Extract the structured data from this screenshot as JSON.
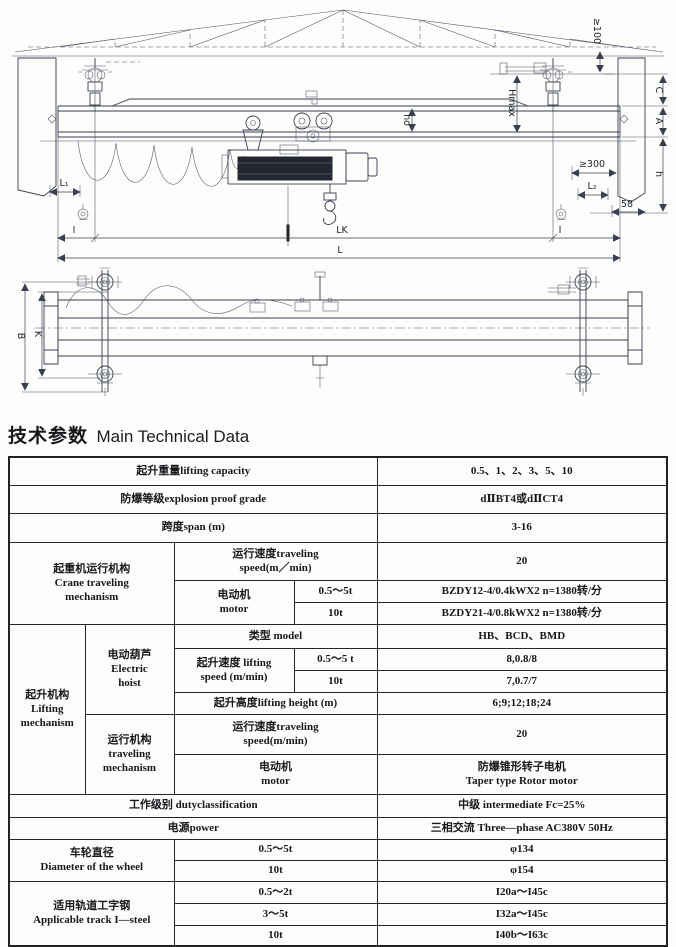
{
  "title": {
    "zh": "技术参数",
    "en": "Main Technical Data"
  },
  "drawing": {
    "front_view": {
      "clearance_top": "≥100",
      "hmax": "Hmax",
      "ho": "ho",
      "dim_c": "C",
      "dim_a": "A",
      "dim_h": "h",
      "clearance_side": "≥300",
      "dim_58": "58",
      "dim_l1": "L₁",
      "dim_l2": "L₂",
      "rail_left": "I",
      "rail_right": "I",
      "dim_lk": "LK",
      "dim_l": "L"
    },
    "plan_view": {
      "dim_b": "B",
      "dim_k": "K"
    }
  },
  "table": {
    "lifting_capacity_label": "起升重量lifting capacity",
    "lifting_capacity_value": "0.5、1、2、3、5、10",
    "explosion_label": "防爆等级explosion proof grade",
    "explosion_value": "dⅡBT4或dⅡCT4",
    "span_label": "跨度span (m)",
    "span_value": "3-16",
    "crane_traveling_group": "起重机运行机构\nCrane traveling\nmechanism",
    "ct_speed_label": "运行速度traveling\nspeed(m／min)",
    "ct_speed_value": "20",
    "ct_motor_label": "电动机\nmotor",
    "ct_motor_t1": "0.5～5t",
    "ct_motor_v1": "BZDY12-4/0.4kWX2  n=1380转/分",
    "ct_motor_t2": "10t",
    "ct_motor_v2": "BZDY21-4/0.8kWX2  n=1380转/分",
    "lifting_group": "起升机构\nLifting\nmechanism",
    "hoist_group": "电动葫芦\nElectric\nhoist",
    "model_label": "类型  model",
    "model_value": "HB、BCD、BMD",
    "lift_speed_label": "起升速度 lifting\nspeed (m/min)",
    "lift_speed_t1": "0.5～5 t",
    "lift_speed_v1": "8,0.8/8",
    "lift_speed_t2": "10t",
    "lift_speed_v2": "7,0.7/7",
    "lift_height_label": "起升高度lifting height (m)",
    "lift_height_value": "6;9;12;18;24",
    "hoist_travel_group": "运行机构\ntraveling\nmechanism",
    "ht_speed_label": "运行速度traveling\nspeed(m/min)",
    "ht_speed_value": "20",
    "ht_motor_label": "电动机\nmotor",
    "ht_motor_value": "防爆锥形转子电机\nTaper type Rotor motor",
    "duty_label": "工作级别  dutyclassification",
    "duty_value": "中级  intermediate Fc=25%",
    "power_label": "电源power",
    "power_value": "三相交流  Three—phase AC380V 50Hz",
    "wheel_group": "车轮直径\nDiameter of the wheel",
    "wheel_t1": "0.5～5t",
    "wheel_v1": "φ134",
    "wheel_t2": "10t",
    "wheel_v2": "φ154",
    "track_group": "适用轨道工字钢\nApplicable track I—steel",
    "track_t1": "0.5～2t",
    "track_v1": "I20a～I45c",
    "track_t2": "3～5t",
    "track_v2": "I32a～I45c",
    "track_t3": "10t",
    "track_v3": "I40b～I63c"
  }
}
